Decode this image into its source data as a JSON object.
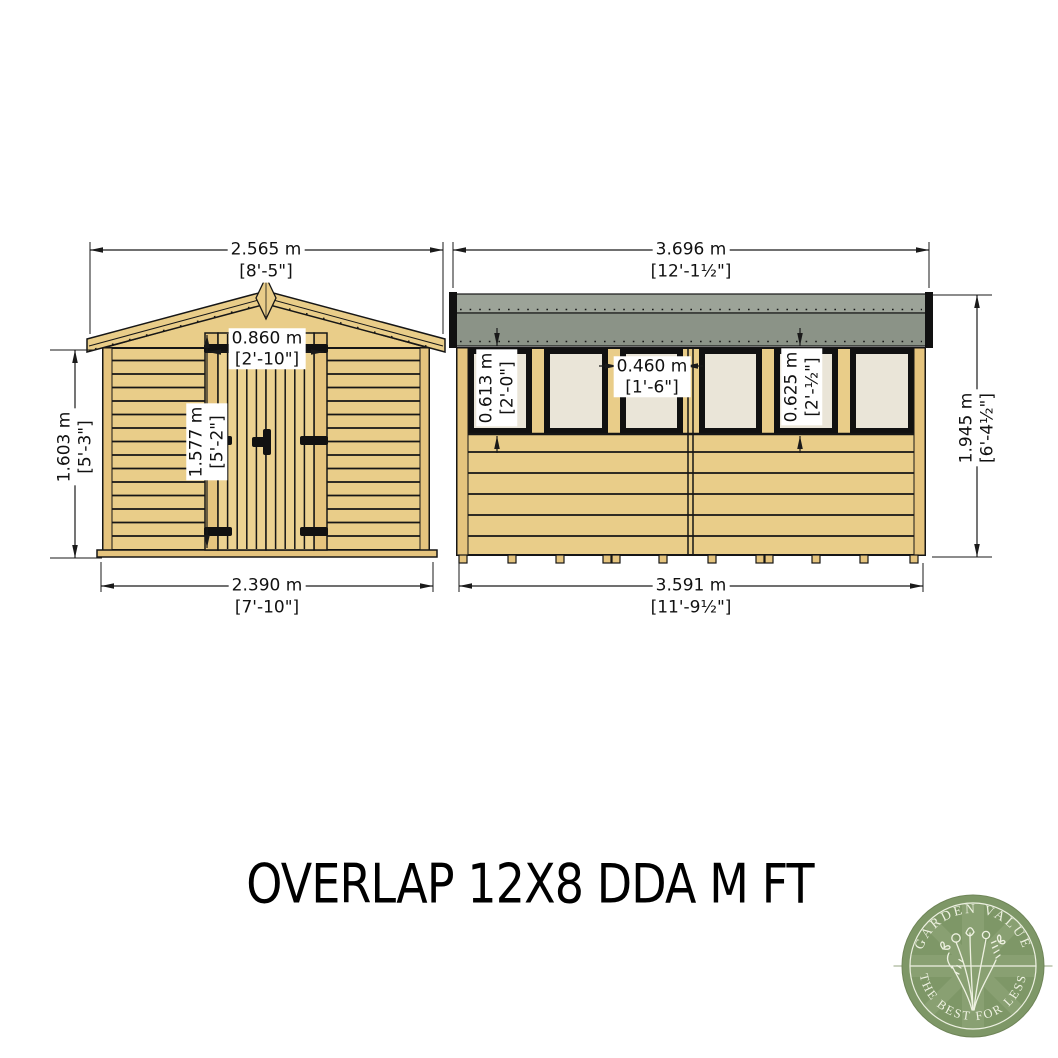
{
  "title": "OVERLAP 12X8 DDA M FT",
  "front_view": {
    "roof_width": {
      "metric": "2.565 m",
      "imperial": "[8'-5\"]"
    },
    "wall_height": {
      "metric": "1.603 m",
      "imperial": "[5'-3\"]"
    },
    "door_width": {
      "metric": "0.860 m",
      "imperial": "[2'-10\"]"
    },
    "door_height": {
      "metric": "1.577 m",
      "imperial": "[5'-2\"]"
    },
    "base_width": {
      "metric": "2.390 m",
      "imperial": "[7'-10\"]"
    }
  },
  "side_view": {
    "roof_width": {
      "metric": "3.696 m",
      "imperial": "[12'-1½\"]"
    },
    "ridge_height": {
      "metric": "1.945 m",
      "imperial": "[6'-4½\"]"
    },
    "window_height_left": {
      "metric": "0.613 m",
      "imperial": "[2'-0\"]"
    },
    "window_width": {
      "metric": "0.460 m",
      "imperial": "[1'-6\"]"
    },
    "window_height_right": {
      "metric": "0.625 m",
      "imperial": "[2'-½\"]"
    },
    "base_width": {
      "metric": "3.591 m",
      "imperial": "[11'-9½\"]"
    }
  },
  "logo": {
    "arc_top": "GARDEN VALUE",
    "arc_bottom": "THE BEST FOR LESS"
  },
  "colors": {
    "wood": "#e9cd89",
    "wood_trim": "#e5c47e",
    "door_wood": "#ecd291",
    "roof_felt_top": "#9ca398",
    "roof_felt": "#8b9387",
    "window_pane": "#eae5d8",
    "logo_green": "#7e9767"
  }
}
